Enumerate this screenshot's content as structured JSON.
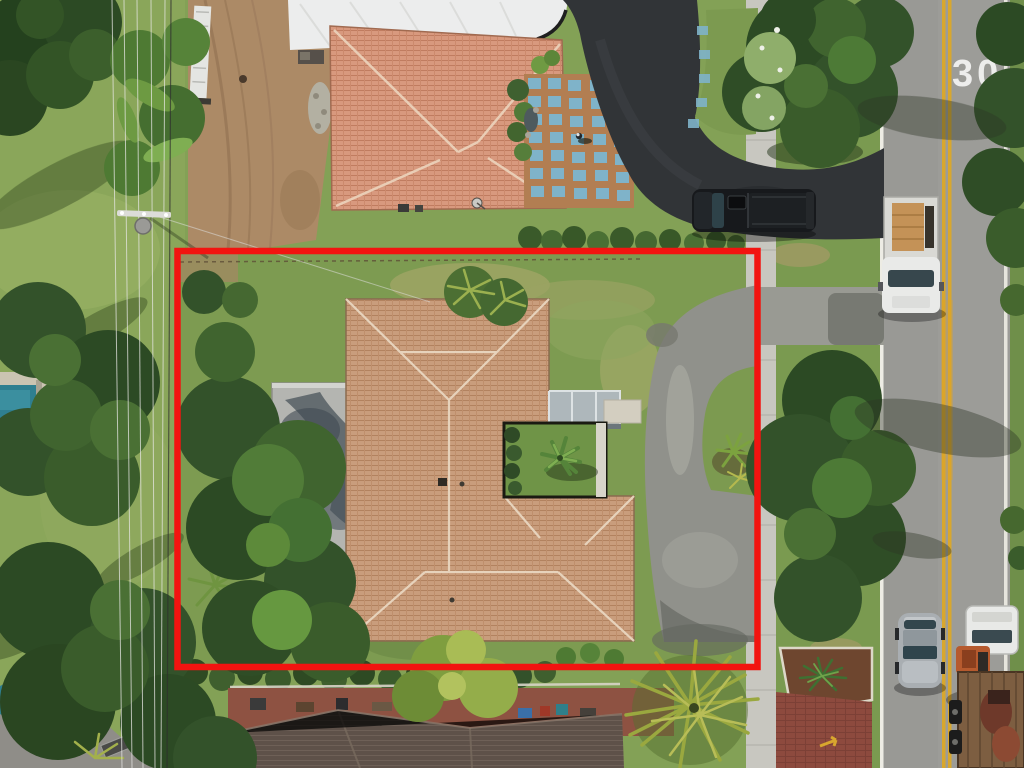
{
  "scene": {
    "type": "aerial-drone-photo",
    "description": "Overhead aerial view of a single-family home parcel outlined with a red property boundary, neighboring houses, street with cars at right"
  },
  "road": {
    "speed_marking": "30",
    "surface_color": "#9c9c98",
    "center_line_color": "#d8a72e",
    "edge_line_color": "#edece4"
  },
  "boundary": {
    "shape": "rectangle",
    "color": "#f21410"
  },
  "colors": {
    "lawn": "#83a156",
    "tree_dark": "#2c4a24",
    "dirt": "#ac8a66",
    "subject_tile_roof": "#c99d7c",
    "neighbor_tile_roof": "#d8997e",
    "flat_gray_roof": "#b4b5b1",
    "asphalt_dark": "#313437",
    "driveway_gray": "#90918b",
    "sidewalk": "#c8c7c0",
    "brick_paving": "#8d4a3e",
    "pool_water": "#2f7f90"
  },
  "objects": {
    "black_pickup": "dark pickup truck parked near driveway apron",
    "white_box_truck": "white utility truck with wooden crate in bed",
    "silver_sedan": "silver sedan driving south",
    "flatbed_truck": "white truck towing flatbed trailer with equipment",
    "pedestrian": "person walking on neighbor patio",
    "utility_pole": "power pole with transformer and overhead lines"
  }
}
